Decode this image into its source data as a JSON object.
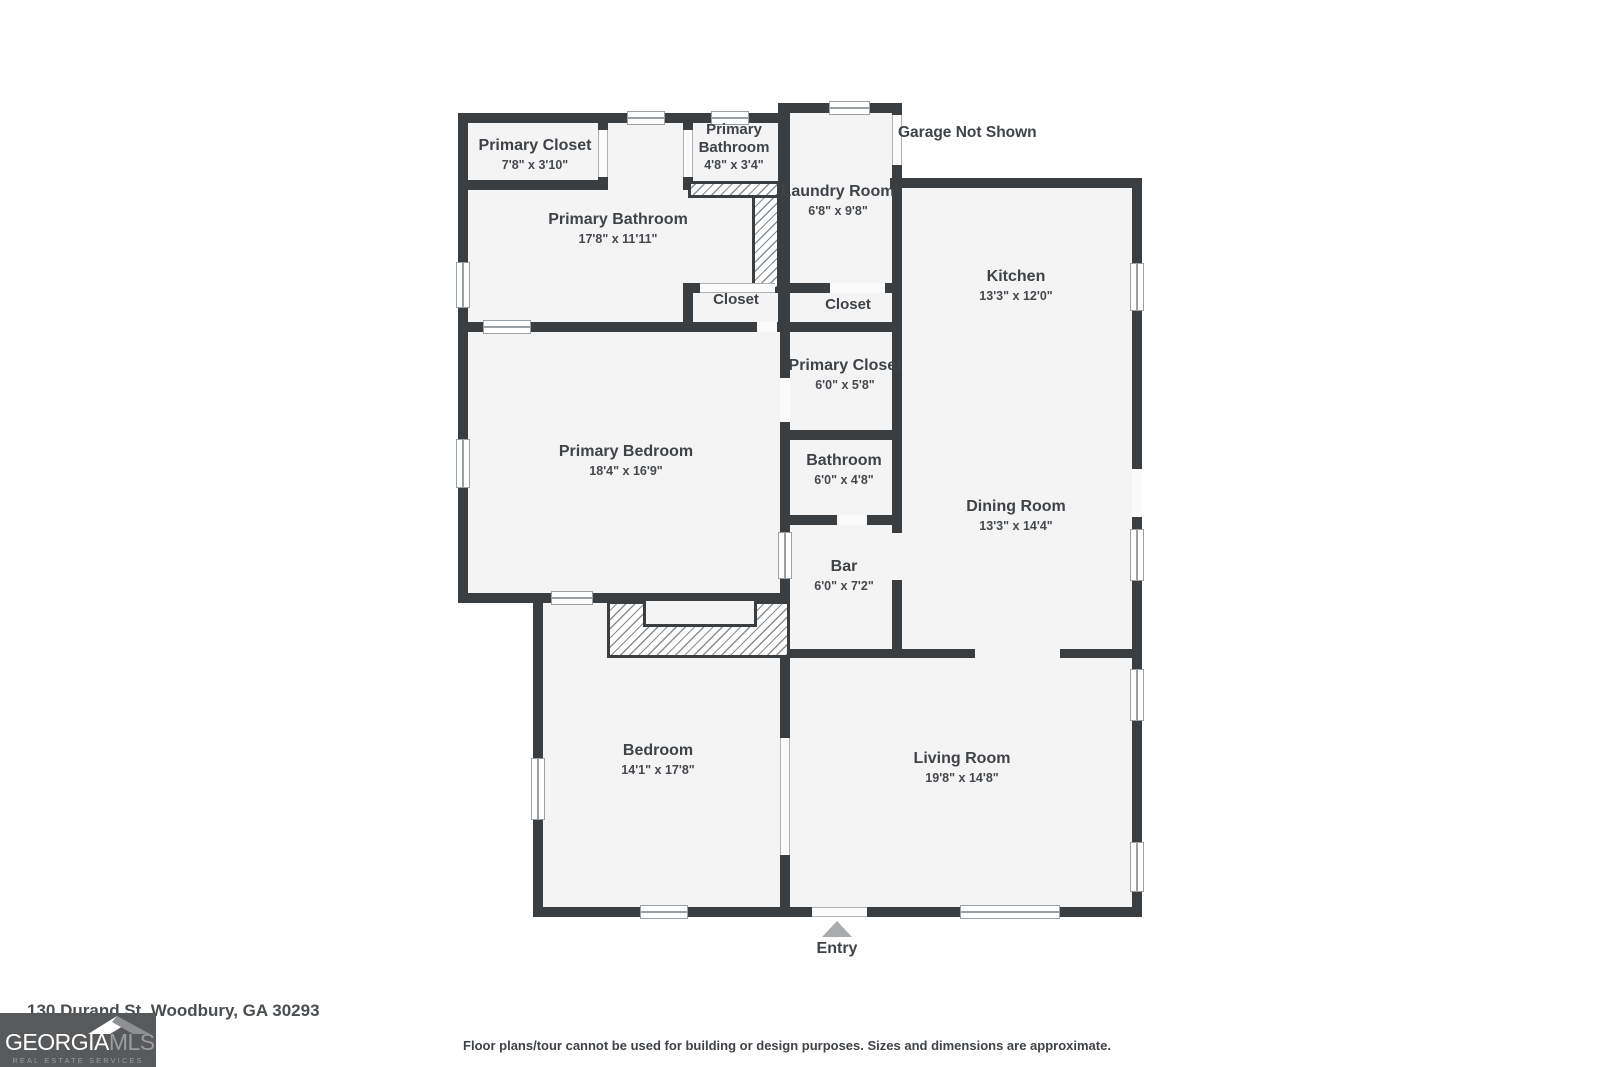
{
  "page": {
    "address": "130 Durand St, Woodbury, GA 30293",
    "disclaimer": "Floor plans/tour cannot be used for building or design purposes. Sizes and dimensions are approximate.",
    "garage_note": "Garage Not Shown",
    "entry_label": "Entry"
  },
  "logo": {
    "brand_primary": "GEORGIA",
    "brand_secondary": "MLS",
    "tagline": "REAL ESTATE SERVICES",
    "roof_icon": "roof-icon",
    "background_color": "#58595b"
  },
  "floorplan": {
    "wall_color": "#3b3e41",
    "floor_color": "#f4f4f5",
    "label_color": "#3f4347",
    "entry_arrow_color": "#a9abad",
    "rooms": [
      {
        "name": "Primary Closet",
        "dims": "7'8\" x 3'10\""
      },
      {
        "name": "Primary Bathroom",
        "dims": "4'8\" x 3'4\""
      },
      {
        "name": "Laundry Room",
        "dims": "6'8\" x 9'8\""
      },
      {
        "name": "Primary Bathroom",
        "dims": "17'8\" x 11'11\""
      },
      {
        "name": "Kitchen",
        "dims": "13'3\" x 12'0\""
      },
      {
        "name": "Closet",
        "dims": ""
      },
      {
        "name": "Closet",
        "dims": ""
      },
      {
        "name": "Primary Closet",
        "dims": "6'0\" x 5'8\""
      },
      {
        "name": "Bathroom",
        "dims": "6'0\" x 4'8\""
      },
      {
        "name": "Primary Bedroom",
        "dims": "18'4\" x 16'9\""
      },
      {
        "name": "Dining Room",
        "dims": "13'3\" x 14'4\""
      },
      {
        "name": "Bar",
        "dims": "6'0\" x 7'2\""
      },
      {
        "name": "Bedroom",
        "dims": "14'1\" x 17'8\""
      },
      {
        "name": "Living Room",
        "dims": "19'8\" x 14'8\""
      }
    ]
  }
}
